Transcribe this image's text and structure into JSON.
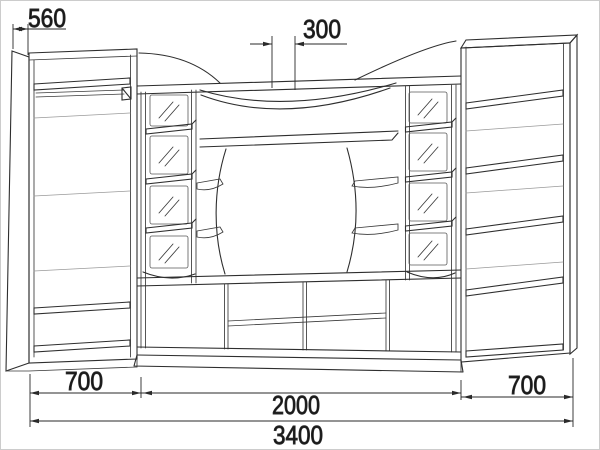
{
  "title": "Wall unit furniture technical drawing",
  "drawing_type": "furniture-front-perspective-scheme",
  "units": "mm",
  "dimensions": {
    "side_depth": "560",
    "top_shelf_depth": "300",
    "left_section_width": "700",
    "center_section_width": "2000",
    "right_section_width": "700",
    "total_width": "3400"
  },
  "components": {
    "left_tower": "wardrobe with hanger rod and shelves",
    "center": "TV niche with curved valance, glass display columns and lower stand",
    "right_tower": "open shelf tower"
  },
  "colors": {
    "background": "#ffffff",
    "line": "#2e2e2e",
    "faint": "#9a9a9a",
    "dimension": "#2a2a2a",
    "text": "#161616",
    "border": "#cccccc"
  }
}
